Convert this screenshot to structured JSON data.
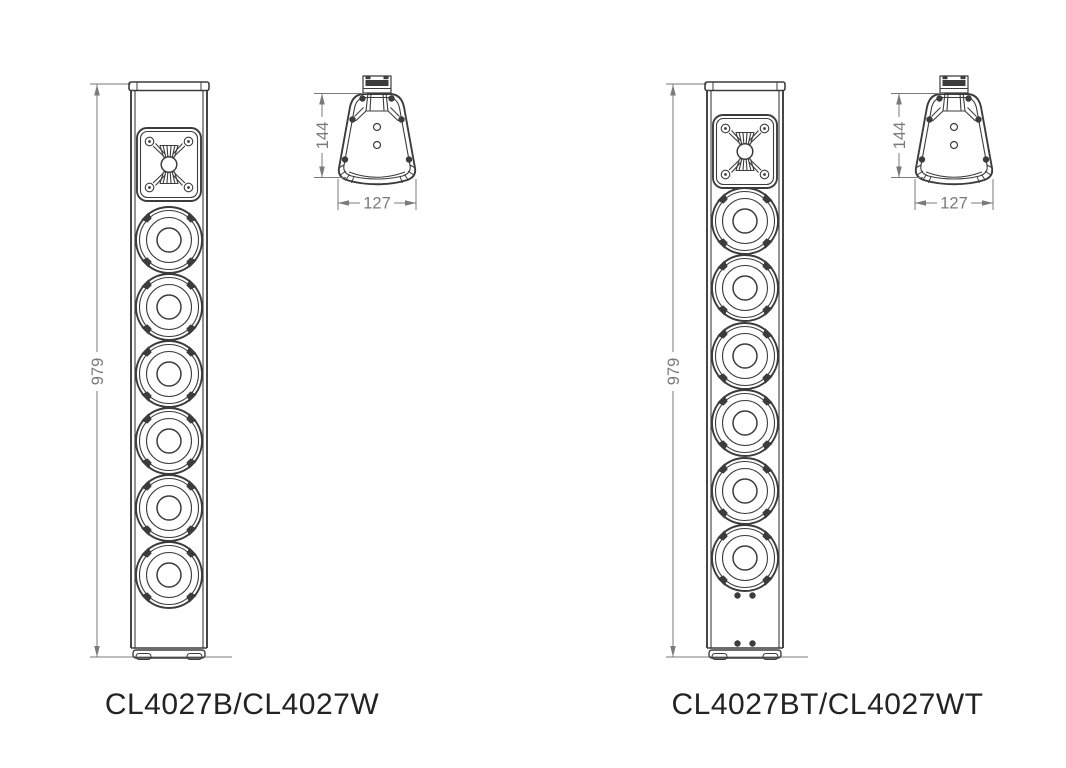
{
  "colors": {
    "line": "#3c3c3c",
    "dim": "#7a7a7a",
    "label": "#232323",
    "background": "#ffffff"
  },
  "figure": {
    "models": [
      {
        "label": "CL4027B/CL4027W",
        "height_dim": "979",
        "depth_dim": "144",
        "width_dim": "127"
      },
      {
        "label": "CL4027BT/CL4027WT",
        "height_dim": "979",
        "depth_dim": "144",
        "width_dim": "127"
      }
    ]
  }
}
